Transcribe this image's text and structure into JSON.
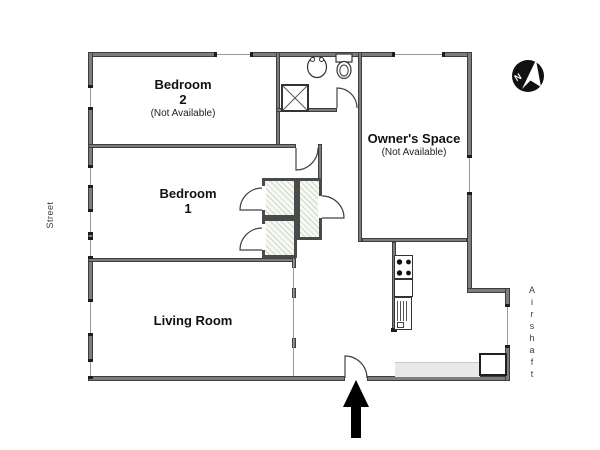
{
  "plan": {
    "title": "Apartment floor plan",
    "rooms": {
      "bedroom2": {
        "name": "Bedroom",
        "number": "2",
        "note": "(Not Available)"
      },
      "bedroom1": {
        "name": "Bedroom",
        "number": "1"
      },
      "living_room": {
        "name": "Living Room"
      },
      "owners_space": {
        "name": "Owner's Space",
        "note": "(Not Available)"
      }
    },
    "surroundings": {
      "street": "Street",
      "airshaft": "Airshaft"
    },
    "compass": {
      "label": "N"
    },
    "icons": [
      "north-arrow-icon",
      "entrance-arrow-icon",
      "sink-icon",
      "toilet-icon",
      "shower-icon",
      "stove-icon",
      "refrigerator-icon",
      "kitchen-counter",
      "entry-closet",
      "closet-hatch",
      "door-swing-arc",
      "window-marker"
    ],
    "colors": {
      "wall": "#7d7d7d",
      "wall_edge": "#3e3e3e",
      "fixture_stroke": "#333333",
      "closet_hatch": "#ccd9c4",
      "compass": "#111111",
      "entrance_arrow": "#000000",
      "counter_fill": "#e8e8e8"
    }
  }
}
